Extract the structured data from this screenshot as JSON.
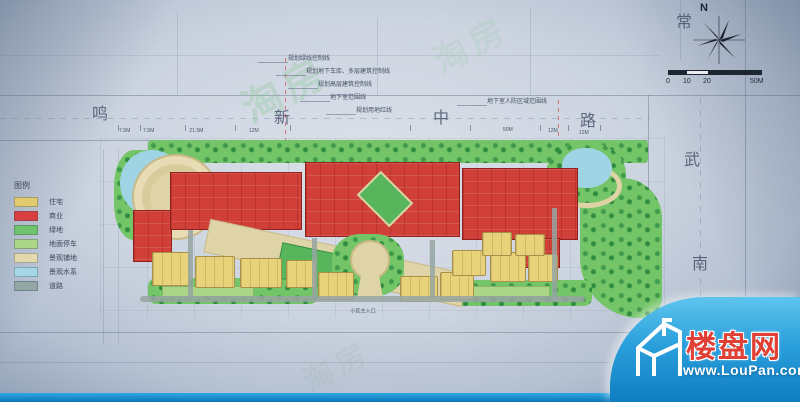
{
  "compass": {
    "north_label": "N"
  },
  "scalebar": {
    "t0": "0",
    "t10": "10",
    "t20": "20",
    "t50": "50M"
  },
  "roads": {
    "north": [
      "鸣",
      "新",
      "中",
      "路"
    ],
    "east": [
      "常",
      "武",
      "南"
    ]
  },
  "legend": {
    "title": "图例",
    "items": [
      {
        "label": "住宅",
        "color": "#e0cb6e"
      },
      {
        "label": "商业",
        "color": "#d84040"
      },
      {
        "label": "绿地",
        "color": "#6fc46d"
      },
      {
        "label": "地面停车",
        "color": "#abd687"
      },
      {
        "label": "景观铺地",
        "color": "#e3d9ad"
      },
      {
        "label": "景观水系",
        "color": "#a5d8e6"
      },
      {
        "label": "道路",
        "color": "#93a8a4"
      }
    ]
  },
  "callouts": {
    "lines": [
      "规划绿线控制线",
      "规划地下车库、多层建筑控制线",
      "规划高层建筑控制线",
      "地下室范围线",
      "规划用地红线"
    ],
    "right": "地下室人防区域范围线"
  },
  "dimensions": {
    "top": [
      "7.5M",
      "7.5M",
      "21.5M",
      "12M",
      "50M",
      "12M",
      "12M"
    ],
    "entrance_label": "小区主入口"
  },
  "ghost_watermark": {
    "text": "淘房"
  },
  "logo": {
    "site_name": "楼盘网",
    "url": "www.LouPan.com",
    "banner_color": "#1b93d4",
    "name_color": "#e04035"
  }
}
